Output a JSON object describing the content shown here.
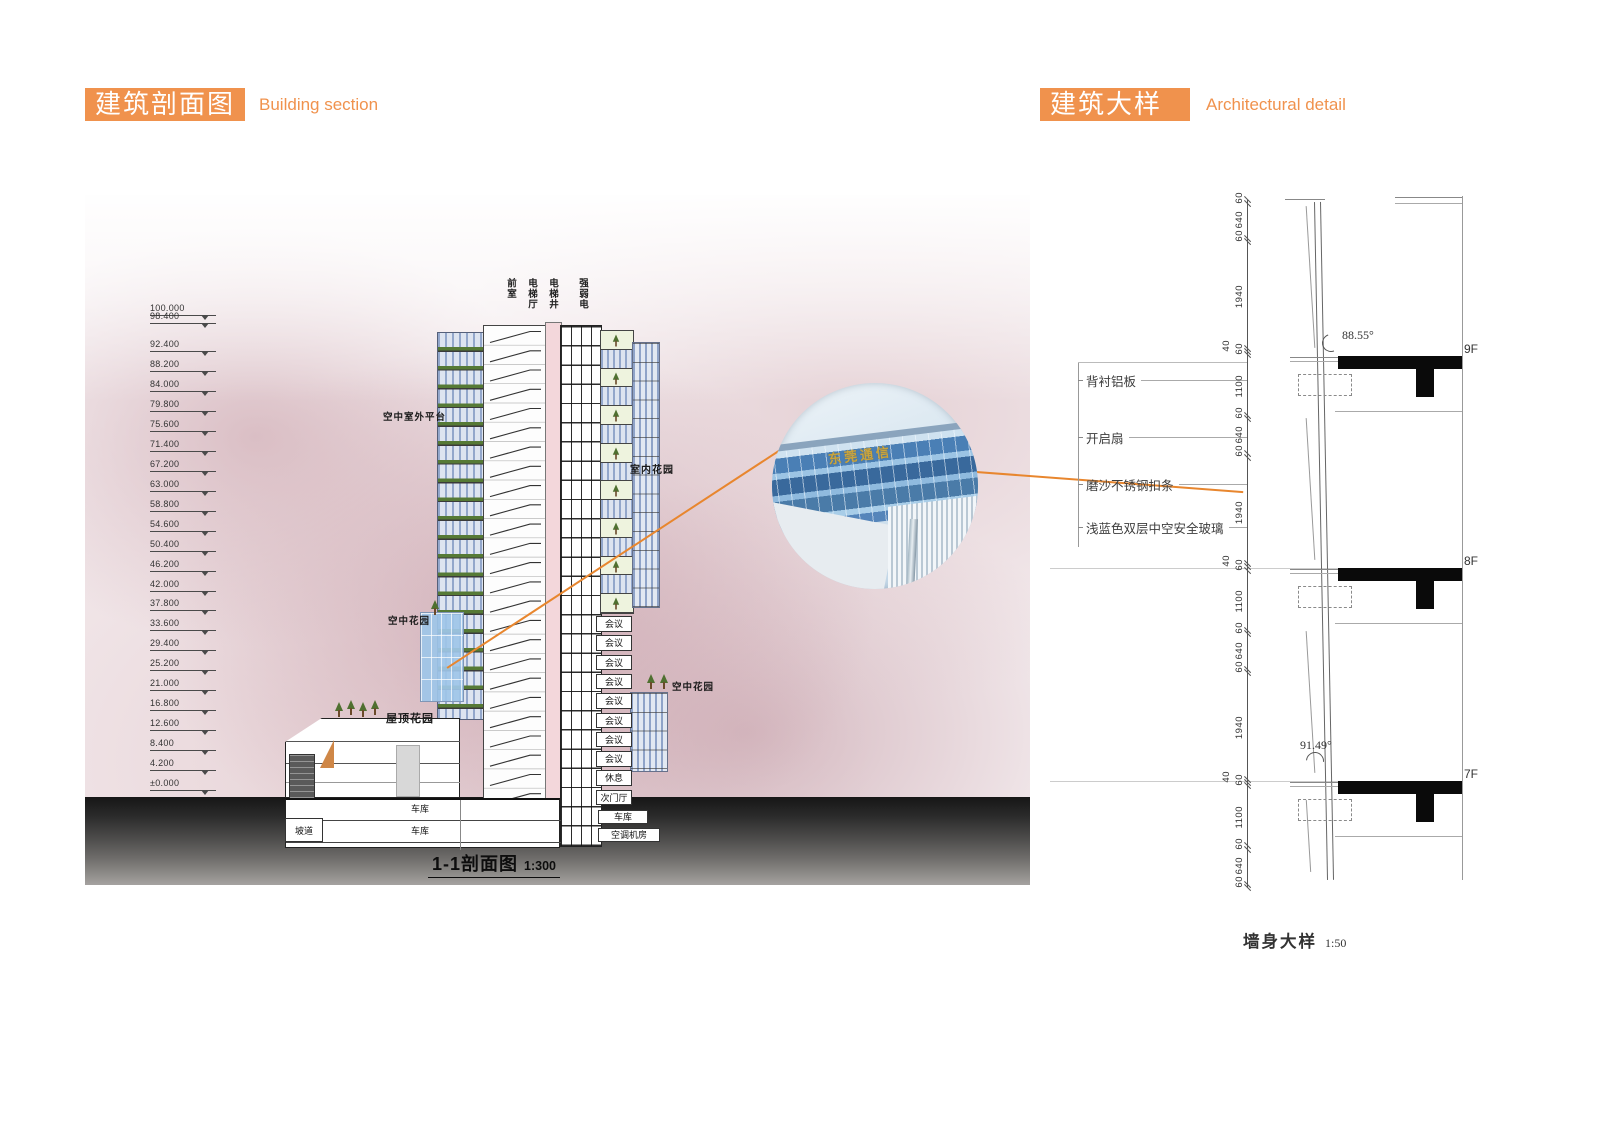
{
  "colors": {
    "accent": "#f0924d",
    "orange_line": "#e8862e",
    "glass_blue": "#93a7cb",
    "shaft_pink": "#f3d7db",
    "plant_green": "#4f7030",
    "gold_sign": "#c9a43d"
  },
  "header_left": {
    "title": "建筑剖面图",
    "subtitle": "Building section"
  },
  "header_right": {
    "title": "建筑大样",
    "subtitle": "Architectural detail"
  },
  "section_panel": {
    "elevations": [
      "100.000",
      "98.400",
      "92.400",
      "88.200",
      "84.000",
      "79.800",
      "75.600",
      "71.400",
      "67.200",
      "63.000",
      "58.800",
      "54.600",
      "50.400",
      "46.200",
      "42.000",
      "37.800",
      "33.600",
      "29.400",
      "25.200",
      "21.000",
      "16.800",
      "12.600",
      "8.400",
      "4.200",
      "±0.000"
    ],
    "shaft_labels": [
      "前室",
      "电梯厅",
      "电梯井",
      "强弱电"
    ],
    "labels": {
      "sky_outdoor_platform": "空中室外平台",
      "indoor_garden": "室内花园",
      "sky_garden_left": "空中花园",
      "sky_garden_right": "空中花园",
      "roof_garden": "屋顶花园",
      "ramp": "坡道",
      "garage": "车库",
      "hvac_room": "空调机房"
    },
    "room_stack": [
      "会议",
      "会议",
      "会议",
      "会议",
      "会议",
      "会议",
      "会议",
      "会议",
      "休息",
      "次门厅"
    ],
    "basement_rooms": [
      "车库",
      "车库"
    ],
    "caption_title": "1-1剖面图",
    "caption_scale": "1:300"
  },
  "detail_photo": {
    "sign_text": "东莞通信"
  },
  "detail_panel": {
    "callouts": [
      "背衬铝板",
      "开启扇",
      "磨沙不锈钢扣条",
      "浅蓝色双层中空安全玻璃"
    ],
    "dimensions": [
      "60",
      "640",
      "60",
      "1940",
      "40",
      "60",
      "1100",
      "60",
      "640",
      "60",
      "1940",
      "40",
      "60",
      "1100",
      "60",
      "640",
      "60",
      "1940",
      "40",
      "60",
      "1100",
      "60",
      "640",
      "60"
    ],
    "floors": [
      "9F",
      "8F",
      "7F"
    ],
    "angle_top": "88.55°",
    "angle_bottom": "91.49°",
    "caption_title": "墙身大样",
    "caption_scale": "1:50"
  }
}
